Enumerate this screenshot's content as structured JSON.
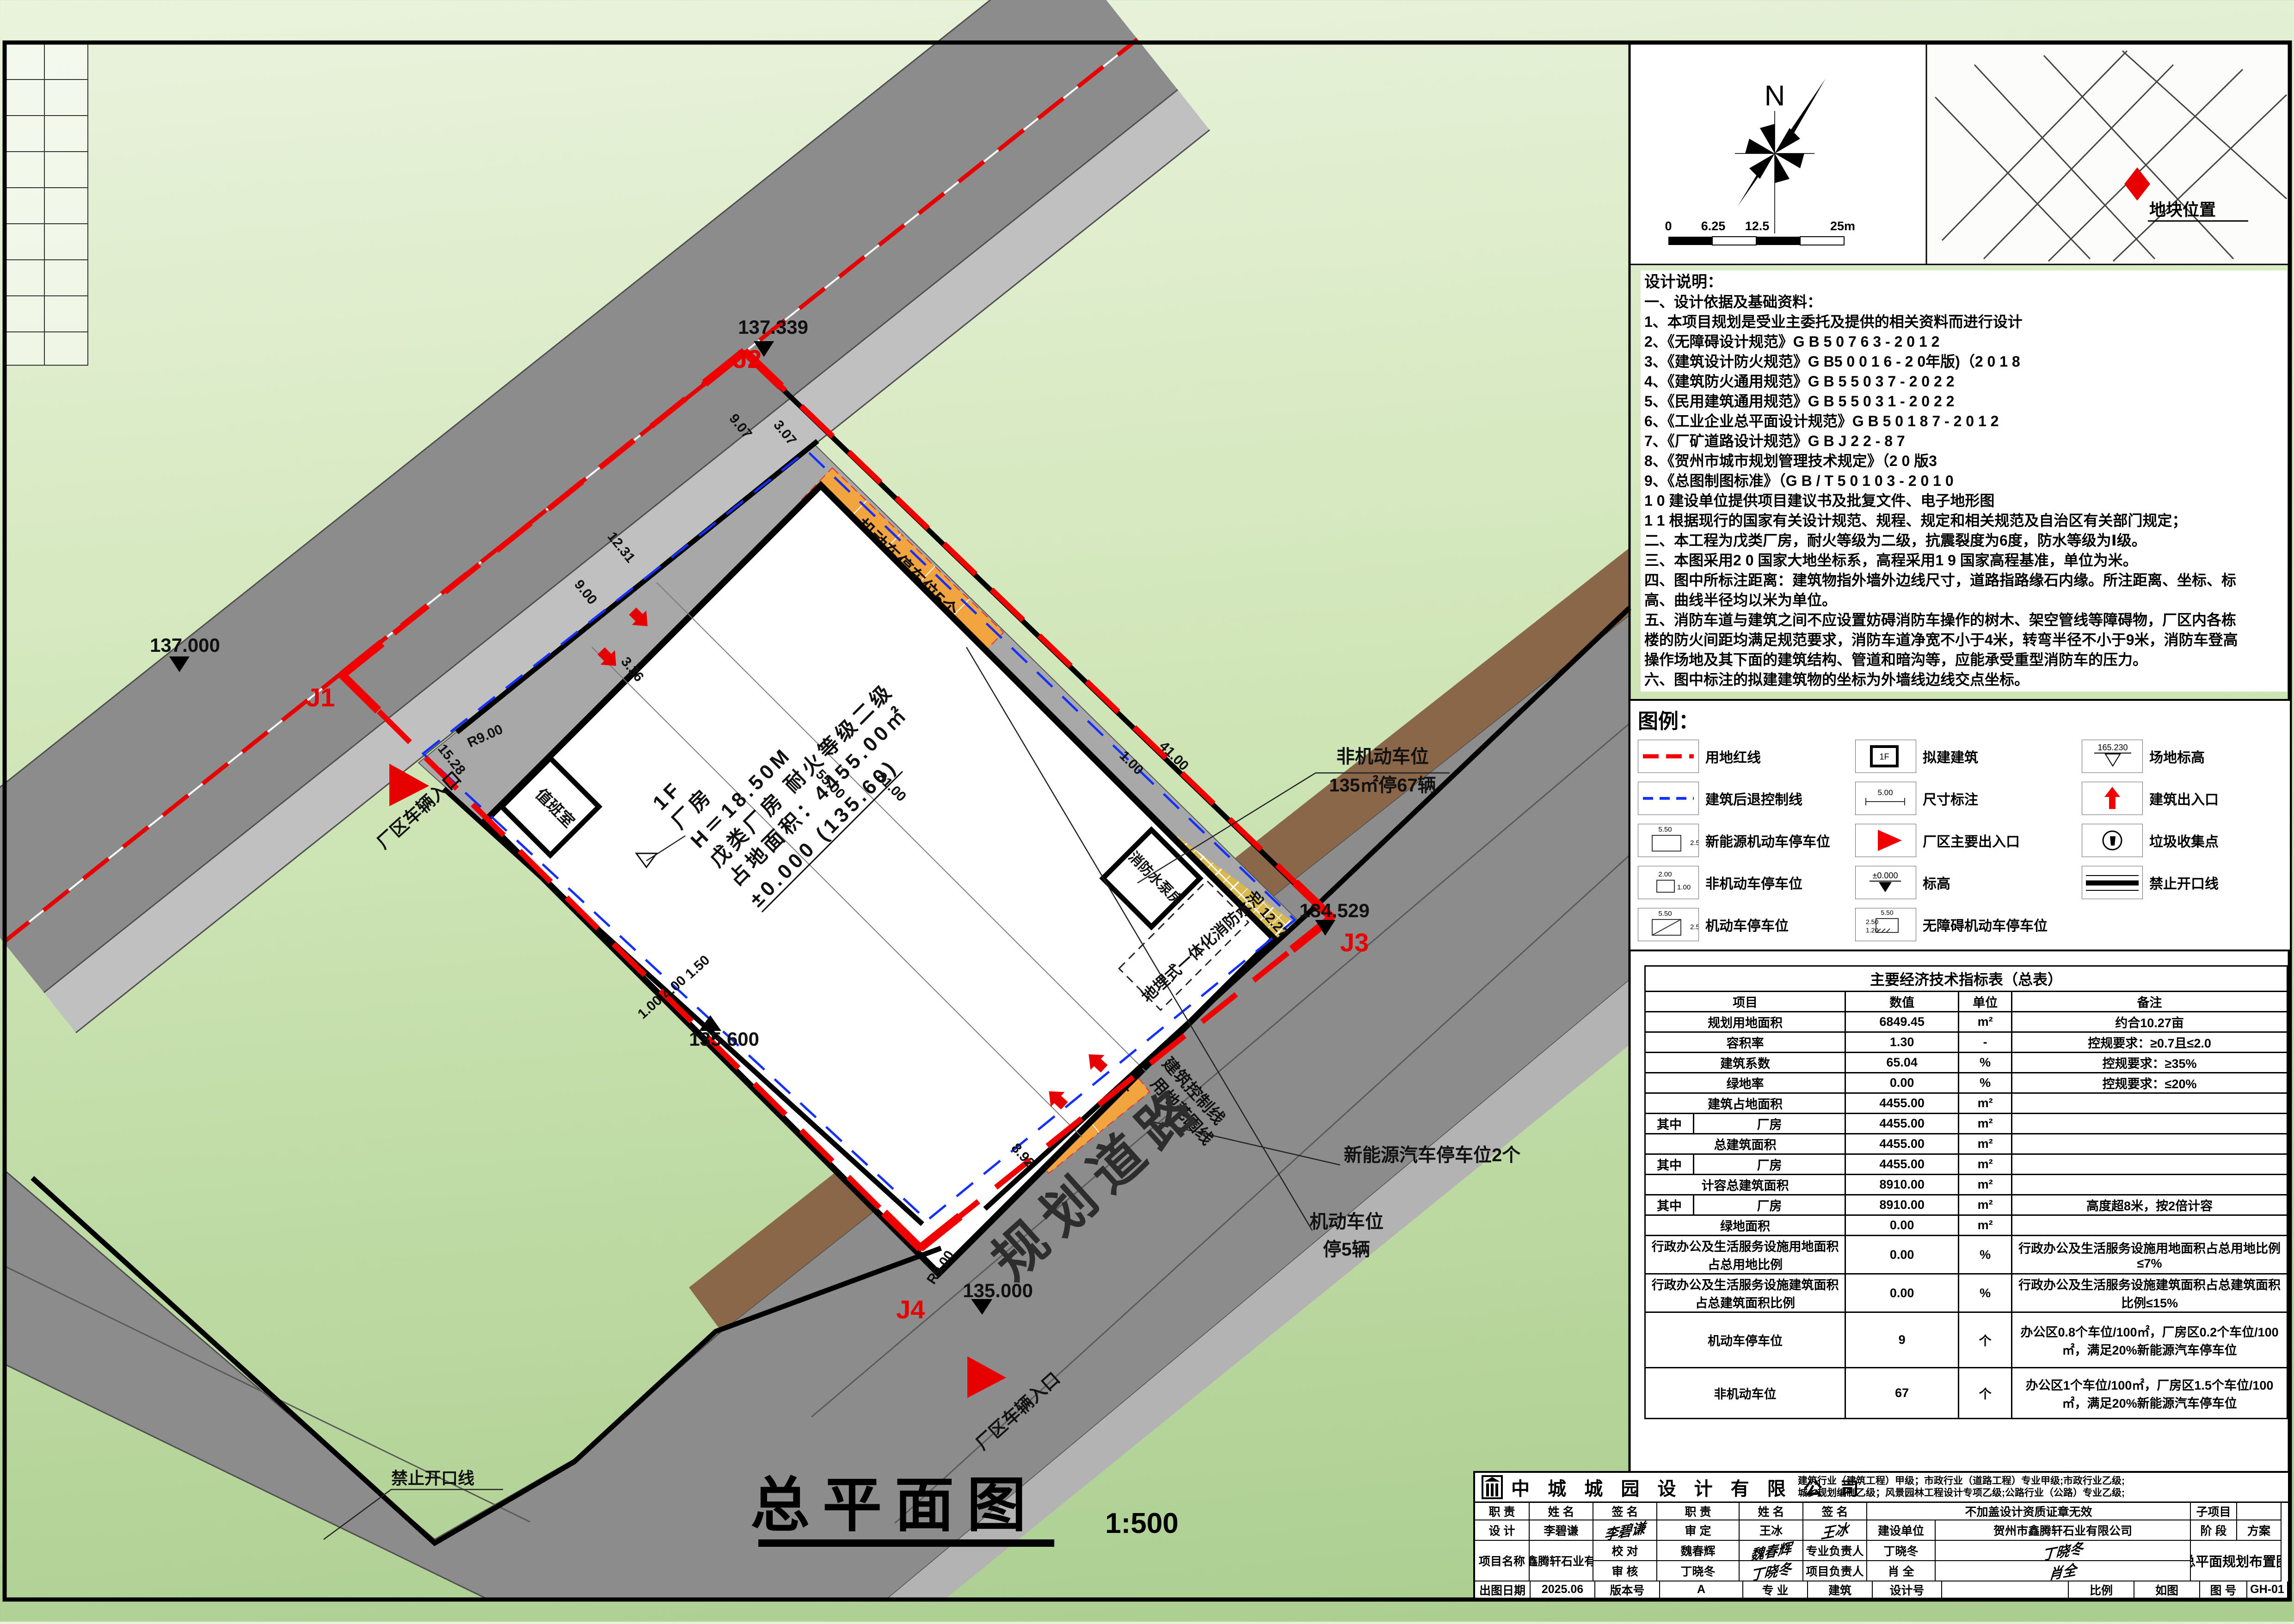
{
  "compass": {
    "north": "N"
  },
  "scalebar": {
    "t0": "0",
    "t1": "6.25",
    "t2": "12.5",
    "t3": "25m"
  },
  "map": {
    "site_label": "地块位置"
  },
  "notes": {
    "title": "设计说明：",
    "lines": [
      "一、设计依据及基础资料：",
      "1、本项目规划是受业主委托及提供的相关资料而进行设计",
      "2、《无障碍设计规范》G B 5 0 7 6 3 - 2 0 1 2",
      "3、《建筑设计防火规范》G B5 0 0 1 6 - 2 0年版)（2 0 1 8",
      "4、《建筑防火通用规范》G B 5 5 0 3 7 - 2 0 2 2",
      "5、《民用建筑通用规范》G B 5 5 0 3 1 - 2 0 2 2",
      "6、《工业企业总平面设计规范》G B 5 0 1 8 7 - 2 0 1 2",
      "7、《厂矿道路设计规范》G B J 2 2 - 8 7",
      "8、《贺州市城市规划管理技术规定》（2 0 版3",
      "9、《总图制图标准》（G B / T 5 0 1 0 3 - 2 0 1 0",
      "1 0 建设单位提供项目建议书及批复文件、电子地形图",
      "1 1 根据现行的国家有关设计规范、规程、规定和相关规范及自治区有关部门规定；",
      "二、本工程为戊类厂房，耐火等级为二级，抗震裂度为6度，防水等级为Ⅰ级。",
      "三、本图采用2 0 国家大地坐标系，高程采用1 9 国家高程基准，单位为米。",
      "四、图中所标注距离：建筑物指外墙外边线尺寸，道路指路缘石内缘。所注距离、坐标、标",
      "高、曲线半径均以米为单位。",
      "五、消防车道与建筑之间不应设置妨碍消防车操作的树木、架空管线等障碍物，厂区内各栋",
      "楼的防火间距均满足规范要求，消防车道净宽不小于4米，转弯半径不小于9米，消防车登高",
      "操作场地及其下面的建筑结构、管道和暗沟等，应能承受重型消防车的压力。",
      "六、图中标注的拟建建筑物的坐标为外墙线边线交点坐标。"
    ]
  },
  "legend": {
    "title": "图例：",
    "red_line": "用地红线",
    "setback": "建筑后退控制线",
    "ev_stall": "新能源机动车停车位",
    "nonmotor_stall": "非机动车停车位",
    "motor_stall": "机动车停车位",
    "proposed": "拟建建筑",
    "proposed_sym": "1F",
    "dim": "尺寸标注",
    "dim_sym": "5.00",
    "main_gate": "厂区主要出入口",
    "level": "标高",
    "level_sym": "±0.000",
    "accessible": "无障碍机动车停车位",
    "site_level": "场地标高",
    "site_level_sym": "165.230",
    "bldg_entry": "建筑出入口",
    "trash": "垃圾收集点",
    "no_open": "禁止开口线",
    "s550": "5.50",
    "s250": "2.50",
    "s200": "2.00",
    "s100": "1.00",
    "s120": "1.20"
  },
  "plan": {
    "road_name": "规划道路",
    "entrance1": "厂区车辆入口",
    "entrance2": "厂区车辆入口",
    "no_open": "禁止开口线",
    "ctrl_line": "建筑控制线",
    "bound_line": "用地范围线",
    "bike_l1": "非机动车位",
    "bike_l2": "135㎡停67辆",
    "ev": "新能源汽车停车位2个",
    "moto_l1": "机动车位",
    "moto_l2": "停5辆",
    "stall5": "机动车停车位5个",
    "stall2": "机动车停车位2个",
    "pool": "地埋式一体化消防水池",
    "pump": "消防水泵房",
    "guard": "值班室",
    "bldg": {
      "l1": "1F",
      "l2": "厂房",
      "l3": "H＝18.50M",
      "l4": "戊类厂房 耐火等级二级",
      "l5": "占地面积：4455.00㎡",
      "l6": "±0.000 (135.60)"
    },
    "pts": {
      "j1": "J1",
      "j2": "J2",
      "j3": "J3",
      "j4": "J4",
      "e1": "137.000",
      "e2": "137.339",
      "e3": "134.529",
      "e4": "135.000",
      "e5": "135.600"
    },
    "dims": {
      "d1": "9.07",
      "d2": "3.07",
      "d3": "12.31",
      "d4": "9.00",
      "d5": "3.36",
      "d6": "15.28",
      "d7": "R9.00",
      "d8": "R9.00",
      "d9": "1.00",
      "d10": "4.00",
      "d11": "1.50",
      "d12": "8.92",
      "d13": "12.27",
      "d14": "55.00",
      "d15": "81.00",
      "d16": "41.00",
      "d17": "1.00"
    },
    "title": "总平面图",
    "scale": "1:500"
  },
  "table": {
    "title": "主要经济技术指标表（总表）",
    "h_item": "项目",
    "h_value": "数值",
    "h_unit": "单位",
    "h_note": "备注",
    "rows": [
      {
        "item": "规划用地面积",
        "value": "6849.45",
        "unit": "m²",
        "note": "约合10.27亩"
      },
      {
        "item": "容积率",
        "value": "1.30",
        "unit": "-",
        "note": "控规要求：≥0.7且≤2.0"
      },
      {
        "item": "建筑系数",
        "value": "65.04",
        "unit": "%",
        "note": "控规要求：≥35%"
      },
      {
        "item": "绿地率",
        "value": "0.00",
        "unit": "%",
        "note": "控规要求：≤20%"
      },
      {
        "item": "建筑占地面积",
        "value": "4455.00",
        "unit": "m²",
        "note": ""
      },
      {
        "pre": "其中",
        "item": "厂房",
        "value": "4455.00",
        "unit": "m²",
        "note": ""
      },
      {
        "item": "总建筑面积",
        "value": "4455.00",
        "unit": "m²",
        "note": ""
      },
      {
        "pre": "其中",
        "item": "厂房",
        "value": "4455.00",
        "unit": "m²",
        "note": ""
      },
      {
        "item": "计容总建筑面积",
        "value": "8910.00",
        "unit": "m²",
        "note": ""
      },
      {
        "pre": "其中",
        "item": "厂房",
        "value": "8910.00",
        "unit": "m²",
        "note": "高度超8米，按2倍计容"
      },
      {
        "item": "绿地面积",
        "value": "0.00",
        "unit": "m²",
        "note": ""
      },
      {
        "item": "行政办公及生活服务设施用地面积占总用地比例",
        "value": "0.00",
        "unit": "%",
        "note": "行政办公及生活服务设施用地面积占总用地比例≤7%"
      },
      {
        "item": "行政办公及生活服务设施建筑面积占总建筑面积比例",
        "value": "0.00",
        "unit": "%",
        "note": "行政办公及生活服务设施建筑面积占总建筑面积比例≤15%"
      },
      {
        "item": "机动车停车位",
        "value": "9",
        "unit": "个",
        "note": "办公区0.8个车位/100㎡，厂房区0.2个车位/100㎡，满足20%新能源汽车停车位"
      },
      {
        "item": "非机动车位",
        "value": "67",
        "unit": "个",
        "note": "办公区1个车位/100㎡，厂房区1.5个车位/100㎡，满足20%新能源汽车停车位"
      }
    ]
  },
  "tb": {
    "company": "中 城 城 园 设 计 有 限 公 司",
    "quals1": "建筑行业（建筑工程）甲级；市政行业（道路工程）专业甲级;市政行业乙级;",
    "quals2": "城乡规划编制乙级；风景园林工程设计专项乙级;公路行业（公路）专业乙级;",
    "h_role": "职  责",
    "h_name": "姓  名",
    "h_sign": "签  名",
    "h_role2": "职  责",
    "h_name2": "姓  名",
    "h_sign2": "签  名",
    "stamp": "不加盖设计资质证章无效",
    "sub": "子项目",
    "sub_v": "",
    "r1c1": "设  计",
    "r1c2": "李碧谦",
    "r1c4": "审  定",
    "r1c5": "王冰",
    "r2c1": "校  对",
    "r2c2": "魏春辉",
    "r2c4": "专业负责人",
    "r2c5": "丁晓冬",
    "r3c1": "审  核",
    "r3c2": "丁晓冬",
    "r3c4": "项目负责人",
    "r3c5": "肖  全",
    "sig_design": "李碧谦",
    "sig_review": "王冰",
    "sig_check": "魏春辉",
    "sig_pro": "丁晓冬",
    "sig_audit": "丁晓冬",
    "sig_pm": "肖全",
    "owner": "建设单位",
    "owner_v": "贺州市鑫腾轩石业有限公司",
    "proj": "项目名称",
    "proj_v": "贺州市鑫腾轩石业有限公司",
    "stage": "阶  段",
    "stage_v": "方案",
    "dwg_name": "总平面规划布置图",
    "f1": "出图日期",
    "f1v": "2025.06",
    "f2": "版本号",
    "f2v": "A",
    "f3": "专  业",
    "f3v": "建筑",
    "f4": "设计号",
    "f4v": "",
    "f5": "比例",
    "f5v": "如图",
    "f6": "图  号",
    "f6v": "GH-01"
  }
}
